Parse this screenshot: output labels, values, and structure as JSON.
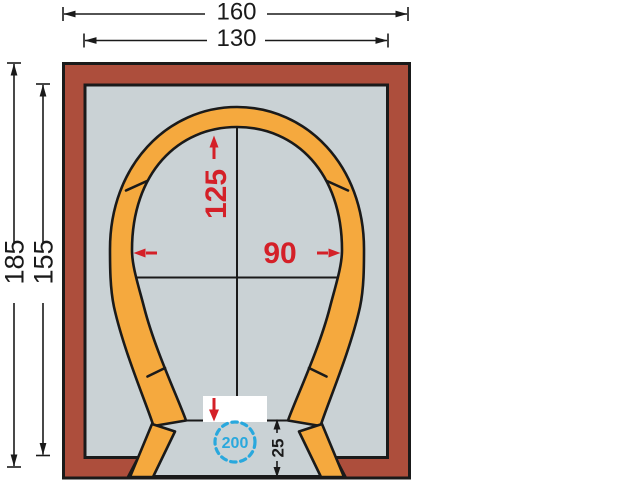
{
  "diagram": {
    "top_dimensions": {
      "outer_width": "160",
      "inner_width": "130"
    },
    "left_dimensions": {
      "outer_height": "185",
      "inner_height": "155"
    },
    "dome_dimensions": {
      "dome_height": "125",
      "dome_width": "90"
    },
    "hearth": {
      "circle_label": "200",
      "ledge_depth": "25"
    },
    "colors": {
      "wall_red": "#ad4e3c",
      "interior_gray": "#cad2d5",
      "arch_orange": "#f5a93e",
      "annotation_red": "#d42028",
      "annotation_blue": "#29a8dd",
      "line_black": "#1a1a1a",
      "background": "#ffffff"
    }
  }
}
